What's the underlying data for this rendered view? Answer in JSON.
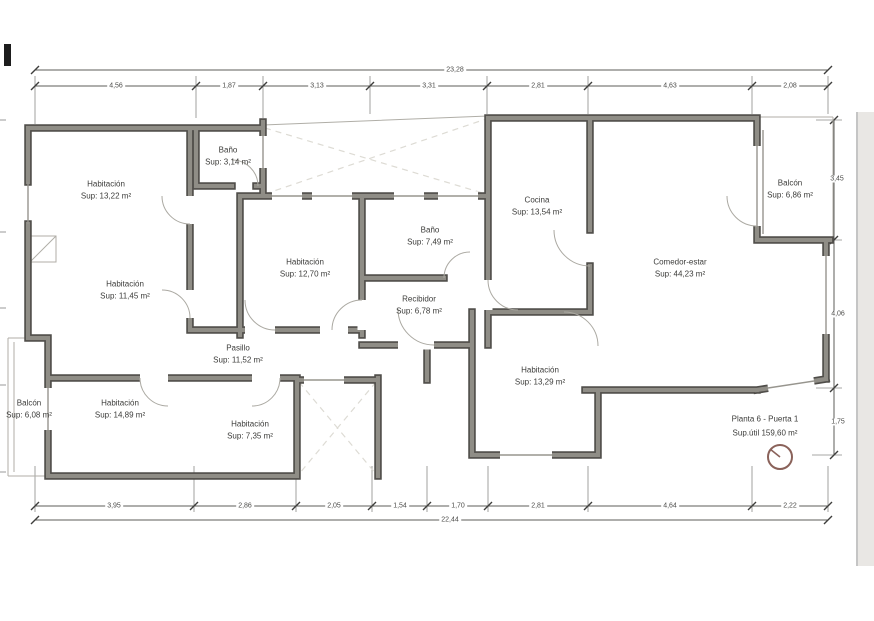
{
  "drawing": {
    "rooms": [
      {
        "id": "habitacion-1",
        "name": "Habitación",
        "area": "Sup: 13,22 m²"
      },
      {
        "id": "bano-1",
        "name": "Baño",
        "area": "Sup: 3,14 m²"
      },
      {
        "id": "habitacion-2",
        "name": "Habitación",
        "area": "Sup: 11,45 m²"
      },
      {
        "id": "habitacion-3",
        "name": "Habitación",
        "area": "Sup: 12,70 m²"
      },
      {
        "id": "bano-2",
        "name": "Baño",
        "area": "Sup: 7,49 m²"
      },
      {
        "id": "recibidor",
        "name": "Recibidor",
        "area": "Sup: 6,78 m²"
      },
      {
        "id": "pasillo",
        "name": "Pasillo",
        "area": "Sup: 11,52 m²"
      },
      {
        "id": "cocina",
        "name": "Cocina",
        "area": "Sup: 13,54 m²"
      },
      {
        "id": "comedor-estar",
        "name": "Comedor-estar",
        "area": "Sup: 44,23 m²"
      },
      {
        "id": "balcon-derecho",
        "name": "Balcón",
        "area": "Sup: 6,86 m²"
      },
      {
        "id": "habitacion-4",
        "name": "Habitación",
        "area": "Sup: 14,89 m²"
      },
      {
        "id": "habitacion-5",
        "name": "Habitación",
        "area": "Sup: 7,35 m²"
      },
      {
        "id": "habitacion-6",
        "name": "Habitación",
        "area": "Sup: 13,29 m²"
      },
      {
        "id": "balcon-izquierdo",
        "name": "Balcón",
        "area": "Sup: 6,08 m²"
      }
    ],
    "title_block": {
      "line1": "Planta 6 - Puerta 1",
      "line2": "Sup.útil 159,60 m²",
      "icon": "clock-icon"
    },
    "dims": {
      "top_total": "23,28",
      "top_segments": [
        "4,56",
        "1,87",
        "3,13",
        "3,31",
        "2,81",
        "4,63",
        "2,08"
      ],
      "bottom_segments": [
        "3,95",
        "2,86",
        "2,05",
        "1,54",
        "1,70",
        "2,81",
        "4,64",
        "2,22"
      ],
      "bottom_total": "22,44",
      "right_segments": [
        "3,45",
        "4,06",
        "1,75"
      ]
    },
    "colors": {
      "wall_fill": "#8f8d86",
      "wall_outline": "#4f4d49",
      "dimension_line": "#5c5c5a",
      "hatch": "#dddbd4",
      "clock": "#8a625a",
      "page_margin": "#e9e7e4"
    }
  }
}
